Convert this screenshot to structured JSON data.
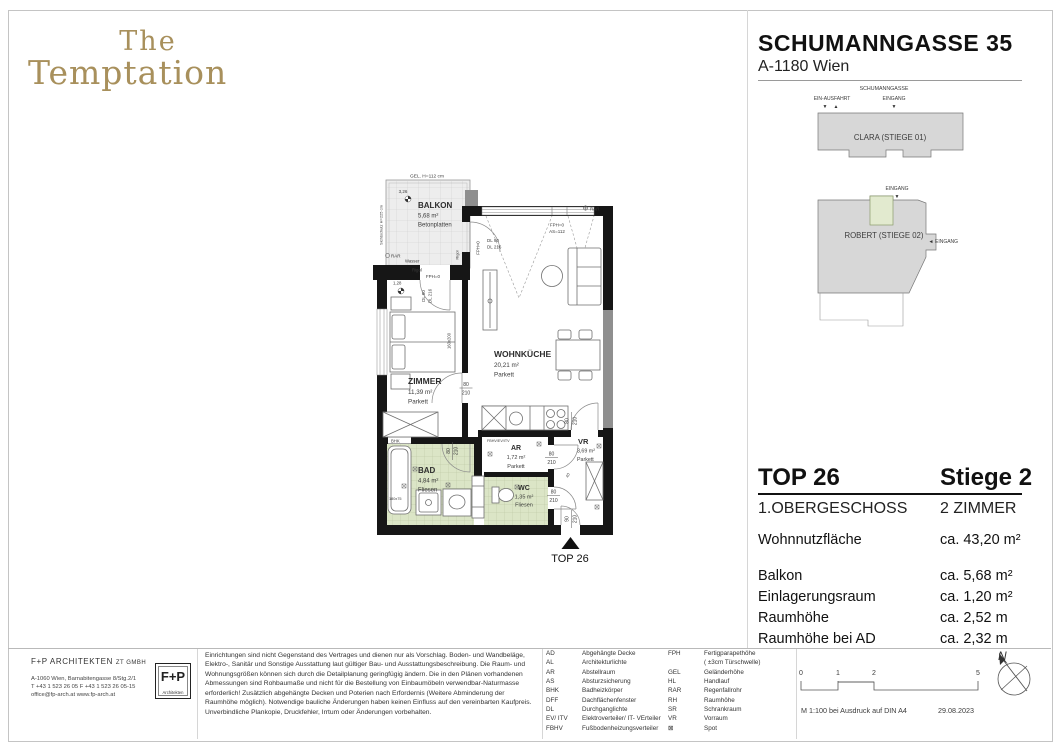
{
  "logo": {
    "line1": "The",
    "line2": "Temptation"
  },
  "header": {
    "title": "SCHUMANNGASSE 35",
    "subtitle": "A-1180 Wien"
  },
  "icons": {
    "arrow_down": "▼",
    "arrow_up": "▲",
    "arrow_left": "◄",
    "spot": "⊠"
  },
  "site_plan": {
    "street": "SCHUMANNGASSE",
    "exit": "EIN-AUSFAHRT",
    "entrance": "EINGANG",
    "building_clara": "CLARA (STIEGE 01)",
    "building_robert": "ROBERT (STIEGE 02)",
    "entrance_robert": "EINGANG",
    "entrance_side": "EINGANG"
  },
  "floor_plan": {
    "rooms": [
      {
        "name": "BALKON",
        "area": "5,68 m²",
        "floor": "Betonplatten"
      },
      {
        "name": "ZIMMER",
        "area": "11,39 m²",
        "floor": "Parkett"
      },
      {
        "name": "WOHNKÜCHE",
        "area": "20,21 m²",
        "floor": "Parkett"
      },
      {
        "name": "BAD",
        "area": "4,84 m²",
        "floor": "Fliesen"
      },
      {
        "name": "AR",
        "area": "1,72 m²",
        "floor": "Parkett"
      },
      {
        "name": "WC",
        "area": "1,35 m²",
        "floor": "Fliesen"
      },
      {
        "name": "VR",
        "area": "3,69 m²",
        "floor": "Parkett"
      }
    ],
    "ann": {
      "gel": "GEL. H=112 cm",
      "dim326": "3,26",
      "dim128": "1,28",
      "dim40": "40",
      "screen": "Sichtschutz H=225 cm",
      "rar": "RAR",
      "wasser": "Wasser",
      "rigol": "Rigol",
      "fph0": "FPH=0",
      "as112": "AS=112",
      "dl90": "DL 90",
      "dl216": "DL 216",
      "dl80": "DL 80",
      "bed": "160x200",
      "tub": "180x75",
      "bhk": "BHK",
      "fbhv": "FBHV/EV/ITV",
      "d80": "80",
      "d210": "210",
      "d90": "90",
      "top": "TOP 26"
    }
  },
  "info_panel": {
    "top_number": "TOP 26",
    "stiege": "Stiege 2",
    "floor_level": "1.OBERGESCHOSS",
    "room_count": "2 ZIMMER",
    "rows": [
      {
        "label": "Wohnnutzfläche",
        "value": "ca. 43,20 m²"
      },
      {
        "label": "Balkon",
        "value": "ca. 5,68 m²"
      },
      {
        "label": "Einlagerungsraum",
        "value": "ca. 1,20 m²"
      },
      {
        "label": "Raumhöhe",
        "value": "ca. 2,52 m"
      },
      {
        "label": "Raumhöhe bei AD",
        "value": "ca. 2,32 m"
      }
    ]
  },
  "footer": {
    "architect": {
      "name": "F+P ARCHITEKTEN",
      "suffix": "ZT GMBH",
      "address": "A-1060 Wien, Barnabitengasse 8/Stg.2/1",
      "contact": "T +43 1 523 26 05    F +43 1 523 26 05-15",
      "web": "office@fp-arch.at      www.fp-arch.at",
      "logo_main": "F+P",
      "logo_sub": "Architekten"
    },
    "disclaimer": "Einrichtungen sind nicht Gegenstand des Vertrages und dienen nur als Vorschlag. Boden- und Wandbeläge, Elektro-, Sanitär und Sonstige Ausstattung laut gültiger Bau- und Ausstattungsbeschreibung. Die Raum- und Wohnungsgrößen können sich durch die Detailplanung geringfügig ändern. Die in den Plänen vorhandenen Abmessungen sind Rohbaumaße und nicht für die Bestellung von Einbaumöbeln  verwendbar-Naturmasse erforderlich! Zusätzlich abgehängte Decken und Poterien nach Erfordernis (Weitere Abminderung der Raumhöhe möglich). Notwendige bauliche Änderungen haben keinen Einfluss auf den vereinbarten Kaufpreis. Unverbindliche Plankopie, Druckfehler, Irrtum oder Änderungen vorbehalten.",
    "legend_col1": [
      {
        "abbr": "AD",
        "label": "Abgehängte Decke"
      },
      {
        "abbr": "AL",
        "label": "Architekturlichte"
      },
      {
        "abbr": "AR",
        "label": "Abstellraum"
      },
      {
        "abbr": "AS",
        "label": "Absturzsicherung"
      },
      {
        "abbr": "BHK",
        "label": "Badheizkörper"
      },
      {
        "abbr": "DFF",
        "label": "Dachflächenfenster"
      },
      {
        "abbr": "DL",
        "label": "Durchganglichte"
      },
      {
        "abbr": "EV/ ITV",
        "label": "Elektroverteiler/ IT- VErteiler"
      },
      {
        "abbr": "FBHV",
        "label": "Fußbodenheizungsverteiler"
      }
    ],
    "legend_col2": [
      {
        "abbr": "FPH",
        "label": "Fertigparapethöhe\n( ±3cm Türschwelle)"
      },
      {
        "abbr": "GEL",
        "label": "Geländerhöhe"
      },
      {
        "abbr": "HL",
        "label": "Handlauf"
      },
      {
        "abbr": "RAR",
        "label": "Regenfallrohr"
      },
      {
        "abbr": "RH",
        "label": "Raumhöhe"
      },
      {
        "abbr": "SR",
        "label": "Schrankraum"
      },
      {
        "abbr": "VR",
        "label": "Vorraum"
      },
      {
        "abbr": "⊠",
        "label": "Spot"
      }
    ],
    "scale": {
      "t0": "0",
      "t1": "1",
      "t2": "2",
      "t5": "5",
      "note": "M 1:100 bei Ausdruck auf DIN A4",
      "date": "29.08.2023"
    },
    "north": "N"
  }
}
